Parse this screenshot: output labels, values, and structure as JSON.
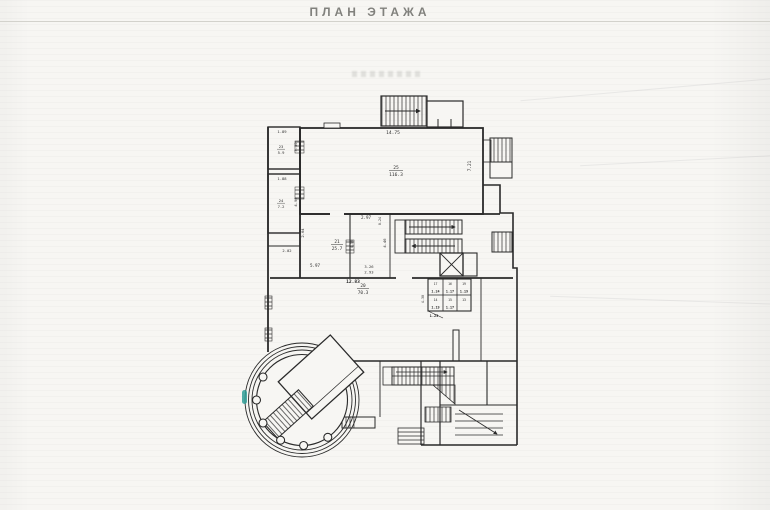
{
  "page": {
    "title": "ПЛАН ЭТАЖА",
    "paper_color": "#f7f6f3",
    "ink_color": "#2a2a2a",
    "accent_teal": "#2f9e97"
  },
  "rooms": [
    {
      "number": "25",
      "area": "116.3"
    },
    {
      "number": "21",
      "area": "25.7"
    },
    {
      "number": "20",
      "area": "70.3"
    },
    {
      "number": "23",
      "area": "5.9"
    },
    {
      "number": "24",
      "area": "7.2"
    }
  ],
  "dims": {
    "top_width": "14.75",
    "hall_height": "7.21",
    "room23_w": "1.89",
    "room23_h": "3.30",
    "room24_w": "1.88",
    "room24_h": "4.90",
    "mid_a": "2.97",
    "mid_b": "0.24",
    "mid_c": "2.64",
    "mid_d": "2.02",
    "mid_e": "5.97",
    "mid_f": "4.58",
    "mid_g": "3.26",
    "mid_h": "2.93",
    "mid_i": "12.83",
    "mid_j": "4.46",
    "mid_k": "4.30"
  },
  "wc_cells": [
    {
      "label": "17",
      "dim": "1.24"
    },
    {
      "label": "16",
      "dim": "1.17"
    },
    {
      "label": "19",
      "dim": "1.19"
    },
    {
      "label": "14",
      "dim": "1.19"
    },
    {
      "label": "15",
      "dim": "1.17"
    },
    {
      "label": "13",
      "dim": "1.23"
    }
  ]
}
